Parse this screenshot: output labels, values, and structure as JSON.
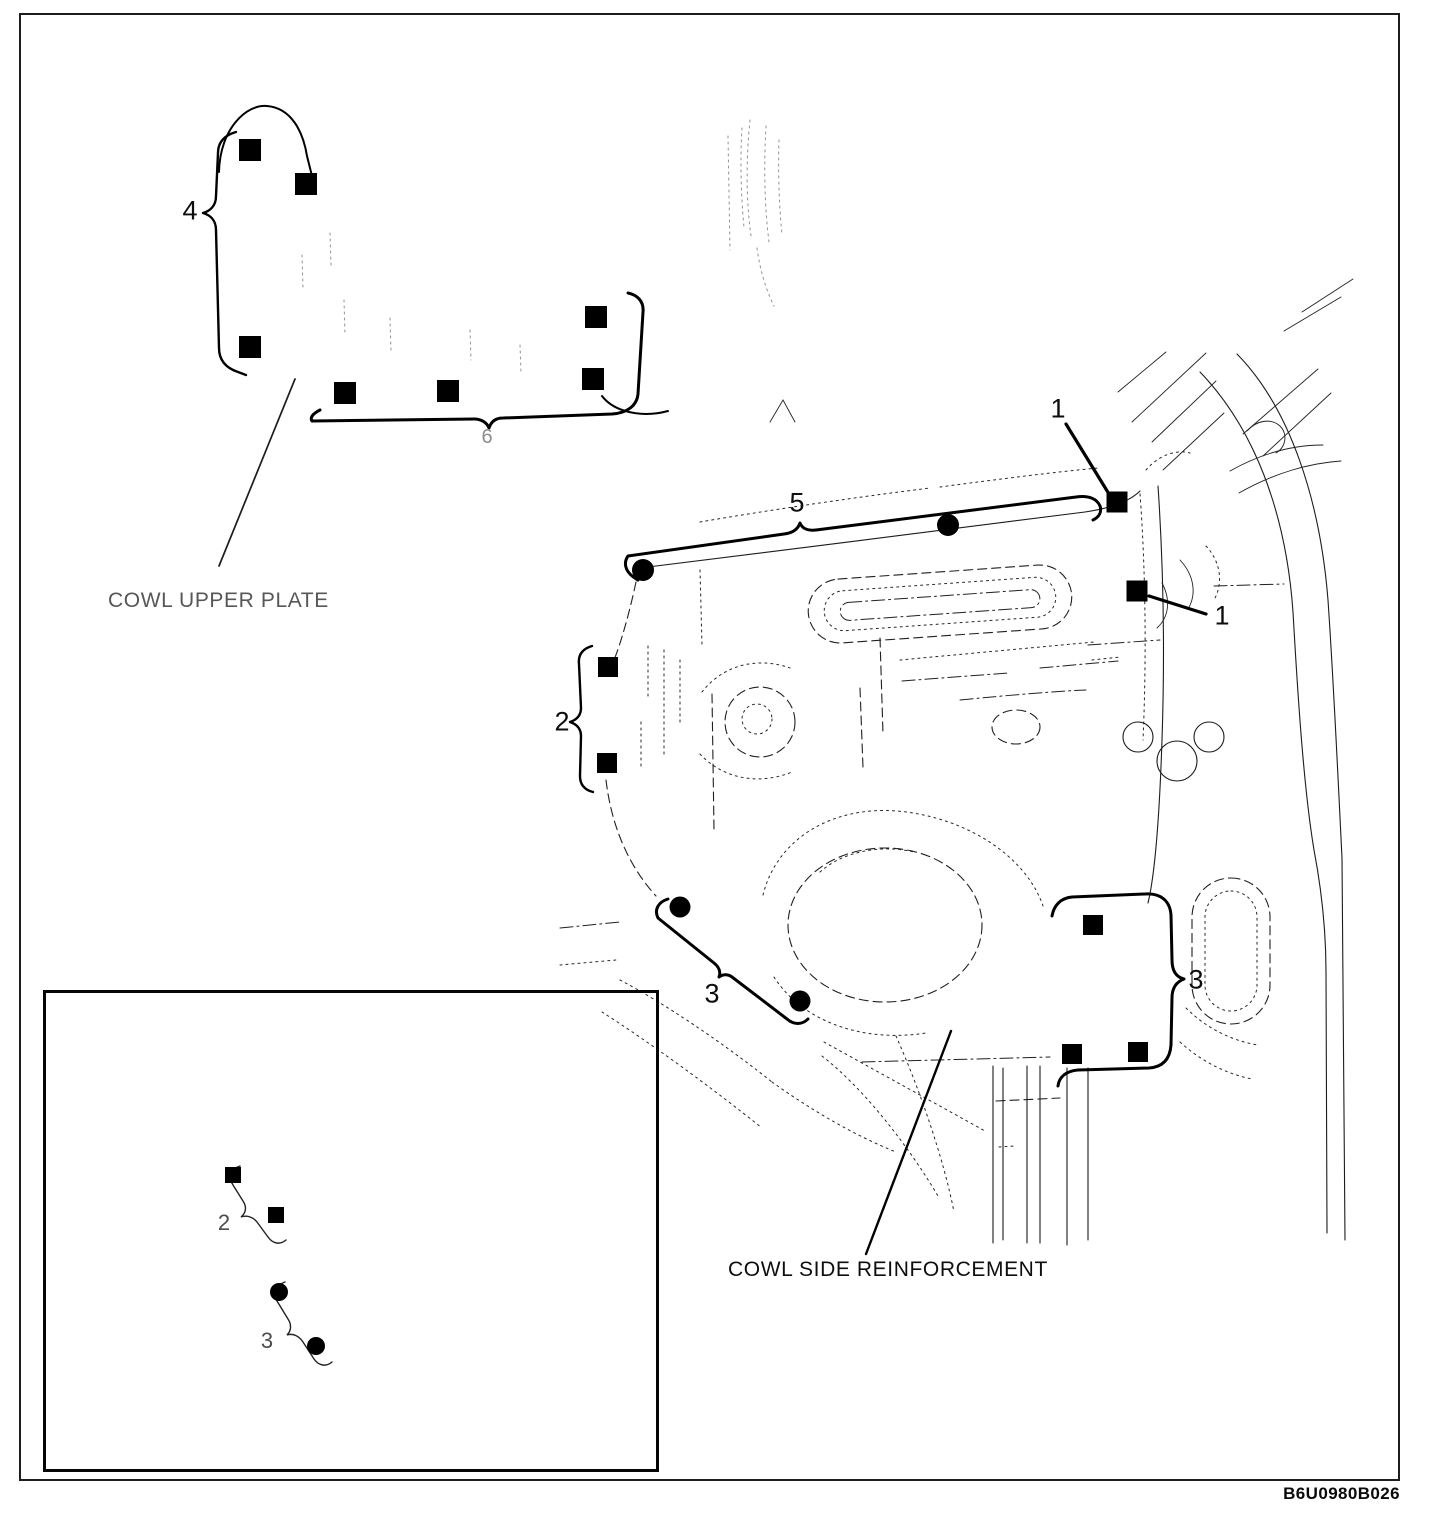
{
  "figure": {
    "labels": {
      "cowl_upper_plate": "COWL UPPER PLATE",
      "cowl_side_reinforcement": "COWL SIDE REINFORCEMENT"
    },
    "ref_code": "B6U0980B026",
    "callouts": [
      {
        "label": "4",
        "x": 190,
        "y": 211,
        "variant": ""
      },
      {
        "label": "6",
        "x": 487,
        "y": 437,
        "variant": "faint"
      },
      {
        "label": "5",
        "x": 797,
        "y": 503,
        "variant": ""
      },
      {
        "label": "1",
        "x": 1058,
        "y": 409,
        "variant": ""
      },
      {
        "label": "1",
        "x": 1222,
        "y": 616,
        "variant": ""
      },
      {
        "label": "2",
        "x": 562,
        "y": 722,
        "variant": ""
      },
      {
        "label": "3",
        "x": 712,
        "y": 994,
        "variant": ""
      },
      {
        "label": "3",
        "x": 1196,
        "y": 980,
        "variant": ""
      },
      {
        "label": "2",
        "x": 224,
        "y": 1223,
        "variant": "inset"
      },
      {
        "label": "3",
        "x": 267,
        "y": 1341,
        "variant": "inset"
      }
    ],
    "weld_markers": [
      {
        "shape": "square",
        "x": 250,
        "y": 150,
        "s": 22
      },
      {
        "shape": "square",
        "x": 306,
        "y": 184,
        "s": 22
      },
      {
        "shape": "square",
        "x": 250,
        "y": 347,
        "s": 22
      },
      {
        "shape": "square",
        "x": 345,
        "y": 393,
        "s": 22
      },
      {
        "shape": "square",
        "x": 448,
        "y": 391,
        "s": 22
      },
      {
        "shape": "square",
        "x": 596,
        "y": 317,
        "s": 22
      },
      {
        "shape": "square",
        "x": 593,
        "y": 379,
        "s": 22
      },
      {
        "shape": "square",
        "x": 1117,
        "y": 502,
        "s": 21
      },
      {
        "shape": "square",
        "x": 1137,
        "y": 591,
        "s": 21
      },
      {
        "shape": "square",
        "x": 608,
        "y": 667,
        "s": 20
      },
      {
        "shape": "square",
        "x": 607,
        "y": 763,
        "s": 20
      },
      {
        "shape": "square",
        "x": 1093,
        "y": 925,
        "s": 20
      },
      {
        "shape": "square",
        "x": 1072,
        "y": 1054,
        "s": 20
      },
      {
        "shape": "square",
        "x": 1138,
        "y": 1052,
        "s": 20
      },
      {
        "shape": "square",
        "x": 233,
        "y": 1175,
        "s": 16
      },
      {
        "shape": "square",
        "x": 276,
        "y": 1215,
        "s": 16
      },
      {
        "shape": "circle",
        "x": 643,
        "y": 570,
        "s": 22
      },
      {
        "shape": "circle",
        "x": 948,
        "y": 525,
        "s": 22
      },
      {
        "shape": "circle",
        "x": 680,
        "y": 907,
        "s": 21
      },
      {
        "shape": "circle",
        "x": 800,
        "y": 1001,
        "s": 21
      },
      {
        "shape": "circle",
        "x": 279,
        "y": 1292,
        "s": 18
      },
      {
        "shape": "circle",
        "x": 316,
        "y": 1346,
        "s": 18
      }
    ]
  }
}
